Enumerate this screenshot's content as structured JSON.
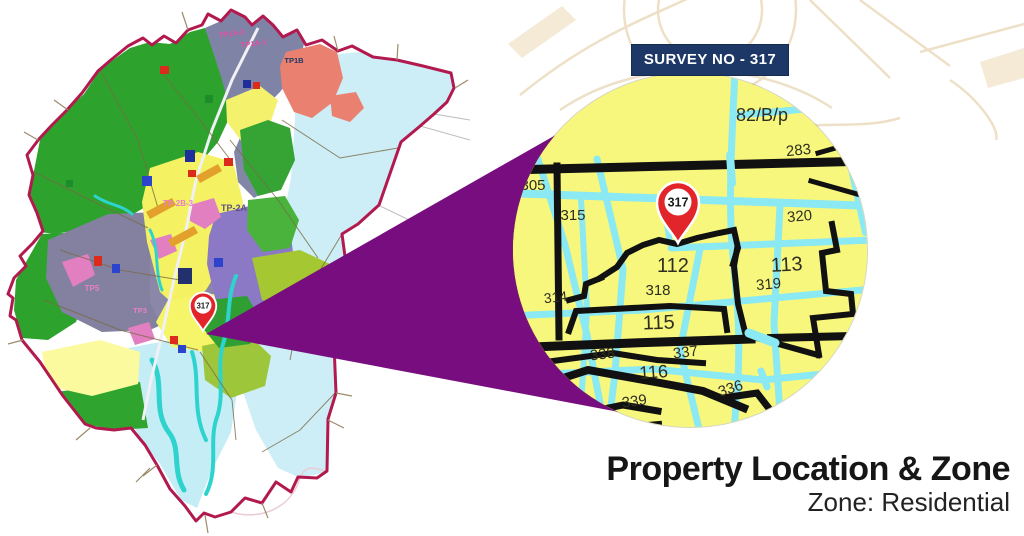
{
  "badge": {
    "text": "SURVEY NO - 317"
  },
  "map_pin": {
    "label": "317"
  },
  "inset_pin": {
    "label": "317"
  },
  "inset": {
    "parcels": [
      {
        "label": "82/B/p"
      },
      {
        "label": "283"
      },
      {
        "label": "305"
      },
      {
        "label": "315"
      },
      {
        "label": "320"
      },
      {
        "label": "112"
      },
      {
        "label": "113"
      },
      {
        "label": "318"
      },
      {
        "label": "319"
      },
      {
        "label": "314"
      },
      {
        "label": "115"
      },
      {
        "label": "338"
      },
      {
        "label": "337"
      },
      {
        "label": "116"
      },
      {
        "label": "336"
      },
      {
        "label": "339"
      }
    ]
  },
  "overview_labels": [
    {
      "label": "TP1A-3"
    },
    {
      "label": "TP1A-1"
    },
    {
      "label": "TP1B"
    },
    {
      "label": "TP-2B-3"
    },
    {
      "label": "TP-2A"
    },
    {
      "label": "TP5"
    },
    {
      "label": "TP3"
    }
  ],
  "title": {
    "heading": "Property Location & Zone",
    "subtitle": "Zone: Residential"
  },
  "colors": {
    "badge_navy": "#1d3866",
    "pin_red": "#e1252b",
    "wedge_purple": "#780d7f",
    "boundary_crimson": "#b2194e",
    "inset_yellow": "#f8f77d",
    "inset_road_cyan": "#8ae9f2",
    "inset_line_black": "#111111",
    "zone_residential_yellow": "#f4f263",
    "zone_green": "#2da32d",
    "zone_pale_cyan": "#cdeef6",
    "zone_slate": "#7f84a6",
    "zone_purple": "#8b79c6",
    "zone_salmon": "#ea8070",
    "zone_lime": "#a5c832"
  }
}
